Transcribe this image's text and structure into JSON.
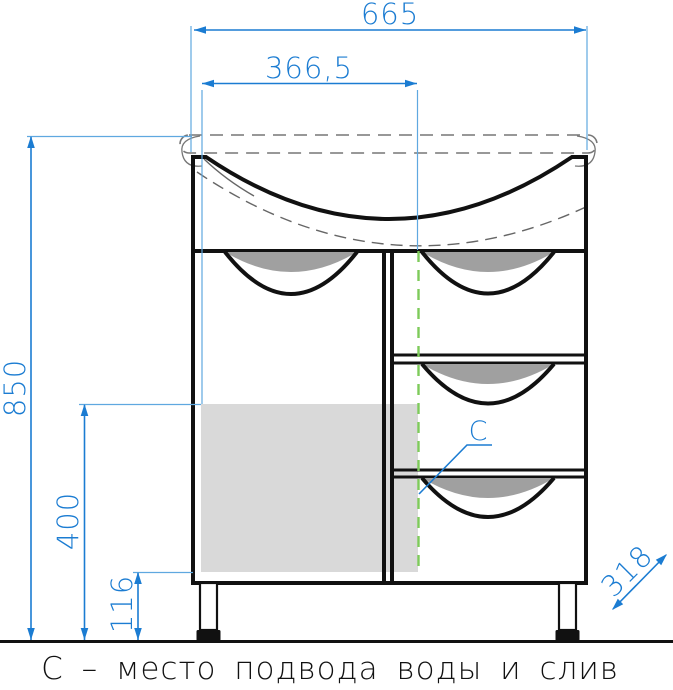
{
  "colors": {
    "dim_blue": "#1b7cd2",
    "ext_blue": "#5fa8e0",
    "zone_green": "#7ecb5a",
    "zone_gray": "#d9d9d9",
    "handle_gray": "#a0a0a0"
  },
  "dimensions": {
    "overall_width": "665",
    "drain_offset": "366,5",
    "overall_height": "850",
    "zone_height": "400",
    "zone_bottom_offset": "116",
    "depth": "318"
  },
  "labels": {
    "drain_marker": "С",
    "caption": "С – место подвода воды и слив"
  }
}
